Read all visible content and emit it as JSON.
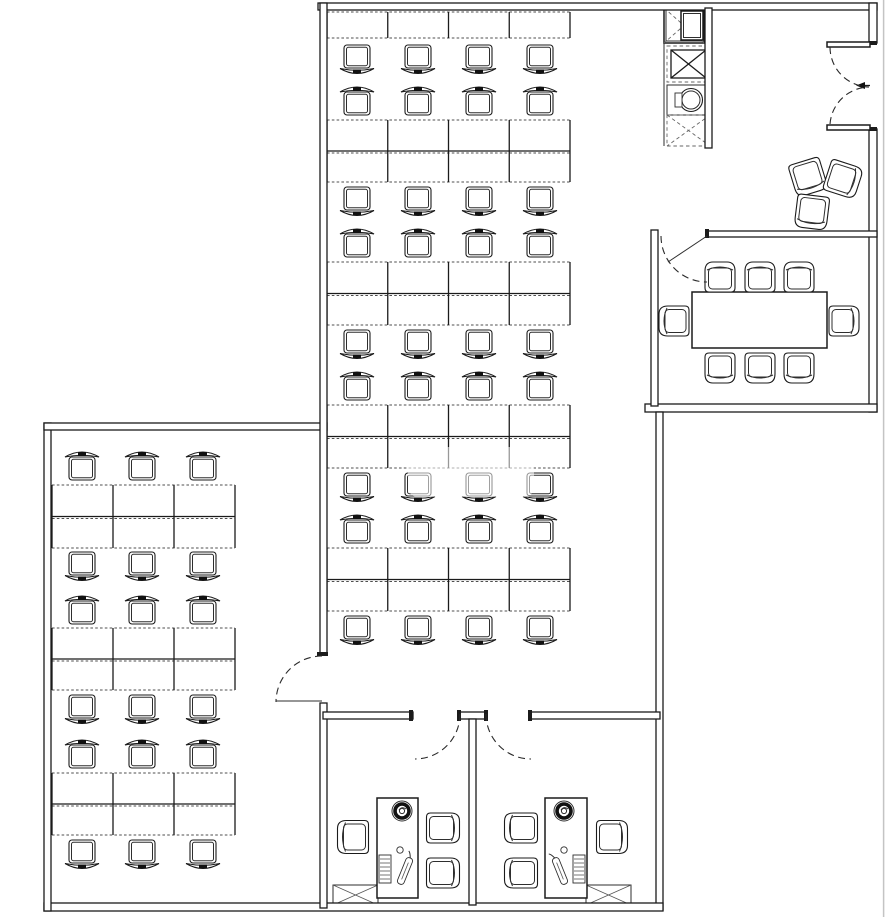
{
  "meta": {
    "title": "Office floor plan drawing",
    "canvas": {
      "w": 885,
      "h": 917
    },
    "colors": {
      "line": "#1b1b1b",
      "desk_dash": "#4f4f4f",
      "background": "#ffffff",
      "canvas_edge": "#c4c4c4"
    }
  },
  "plan": {
    "walls": [
      {
        "id": "top-wall",
        "x": 318,
        "y": 3,
        "w": 559,
        "h": 7
      },
      {
        "id": "right-wall-upper",
        "x": 869,
        "y": 3,
        "w": 8,
        "h": 40
      },
      {
        "id": "right-wall-mid",
        "x": 869,
        "y": 129,
        "w": 8,
        "h": 283
      },
      {
        "id": "conference-bottom-wall",
        "x": 645,
        "y": 404,
        "w": 232,
        "h": 8
      },
      {
        "id": "center-right-wall",
        "x": 656,
        "y": 412,
        "w": 7,
        "h": 498
      },
      {
        "id": "bottom-wall",
        "x": 44,
        "y": 903,
        "w": 619,
        "h": 8
      },
      {
        "id": "left-wing-left-wall",
        "x": 44,
        "y": 423,
        "w": 7,
        "h": 488
      },
      {
        "id": "left-wing-top-wall",
        "x": 44,
        "y": 423,
        "w": 283,
        "h": 7
      },
      {
        "id": "center-left-wall",
        "x": 320,
        "y": 3,
        "w": 7,
        "h": 652
      },
      {
        "id": "lower-left-wall",
        "x": 320,
        "y": 703,
        "w": 7,
        "h": 205
      },
      {
        "id": "office-top-wall-left",
        "x": 323,
        "y": 712,
        "w": 90,
        "h": 7
      },
      {
        "id": "office-top-wall-center",
        "x": 459,
        "y": 712,
        "w": 27,
        "h": 7
      },
      {
        "id": "office-top-wall-right",
        "x": 530,
        "y": 712,
        "w": 130,
        "h": 7
      },
      {
        "id": "office-divider-wall",
        "x": 469,
        "y": 719,
        "w": 7,
        "h": 186
      },
      {
        "id": "conference-left-wall",
        "x": 651,
        "y": 230,
        "w": 7,
        "h": 176
      },
      {
        "id": "conference-top-wall",
        "x": 707,
        "y": 231,
        "w": 170,
        "h": 6
      },
      {
        "id": "shaft-right-wall",
        "x": 705,
        "y": 8,
        "w": 7,
        "h": 140
      }
    ],
    "wall_caps": [
      {
        "x": 409,
        "y": 710,
        "w": 4,
        "h": 11
      },
      {
        "x": 457,
        "y": 710,
        "w": 4,
        "h": 11
      },
      {
        "x": 484,
        "y": 710,
        "w": 4,
        "h": 11
      },
      {
        "x": 528,
        "y": 710,
        "w": 4,
        "h": 11
      },
      {
        "x": 705,
        "y": 229,
        "w": 4,
        "h": 9
      },
      {
        "x": 317,
        "y": 652,
        "w": 11,
        "h": 4
      },
      {
        "x": 869,
        "y": 41,
        "w": 8,
        "h": 4
      },
      {
        "x": 869,
        "y": 127,
        "w": 8,
        "h": 4
      }
    ],
    "entry_door_leaves": [
      {
        "x": 827,
        "y": 42,
        "w": 43,
        "h": 5
      },
      {
        "x": 827,
        "y": 125,
        "w": 43,
        "h": 5
      }
    ],
    "entry_handle": {
      "x1": 856,
      "y1": 85.5,
      "x2": 870,
      "y2": 85.5
    },
    "door_swings": [
      {
        "id": "entry-door-top",
        "d": "M 830 47 A 40 40 0 0 0 869 87"
      },
      {
        "id": "entry-door-bottom",
        "d": "M 830 124 A 40 40 0 0 1 869 87"
      },
      {
        "id": "conference-door",
        "d": "M 661 236 A 46 46 0 0 0 707 282"
      },
      {
        "id": "left-wing-door",
        "d": "M 322 656 A 46 46 0 0 0 276 702"
      },
      {
        "id": "office-left-door",
        "d": "M 460 714 A 45 45 0 0 1 415 759"
      },
      {
        "id": "office-right-door",
        "d": "M 486 714 A 45 45 0 0 0 531 759"
      }
    ],
    "door_leaf_lines": [
      {
        "x1": 276,
        "y1": 701,
        "x2": 322,
        "y2": 701
      },
      {
        "x1": 707,
        "y1": 236,
        "x2": 668,
        "y2": 262
      }
    ],
    "desk_blocks": [
      {
        "id": "center-bank-1",
        "x": 327,
        "y": 12,
        "cols": 4,
        "colw": 60.75,
        "rows": 1,
        "rowh": 26
      },
      {
        "id": "center-bank-2",
        "x": 327,
        "y": 120,
        "cols": 4,
        "colw": 60.75,
        "rows": 2,
        "rowh": 31
      },
      {
        "id": "center-bank-3",
        "x": 327,
        "y": 262,
        "cols": 4,
        "colw": 60.75,
        "rows": 2,
        "rowh": 31.5
      },
      {
        "id": "center-bank-4",
        "x": 327,
        "y": 405,
        "cols": 4,
        "colw": 60.75,
        "rows": 2,
        "rowh": 31.5
      },
      {
        "id": "center-bank-5",
        "x": 327,
        "y": 548,
        "cols": 4,
        "colw": 60.75,
        "rows": 2,
        "rowh": 31.5
      },
      {
        "id": "left-bank-1",
        "x": 52,
        "y": 485,
        "cols": 3,
        "colw": 61,
        "rows": 2,
        "rowh": 31.5
      },
      {
        "id": "left-bank-2",
        "x": 52,
        "y": 628,
        "cols": 3,
        "colw": 61,
        "rows": 2,
        "rowh": 31
      },
      {
        "id": "left-bank-3",
        "x": 52,
        "y": 773,
        "cols": 3,
        "colw": 61,
        "rows": 2,
        "rowh": 31
      }
    ],
    "chair_rows": [
      {
        "area": "center",
        "dir": "up",
        "y": 45,
        "centers": [
          357,
          418,
          479,
          540
        ]
      },
      {
        "area": "center",
        "dir": "down",
        "y": 84,
        "centers": [
          357,
          418,
          479,
          540
        ]
      },
      {
        "area": "center",
        "dir": "up",
        "y": 187,
        "centers": [
          357,
          418,
          479,
          540
        ]
      },
      {
        "area": "center",
        "dir": "down",
        "y": 226,
        "centers": [
          357,
          418,
          479,
          540
        ]
      },
      {
        "area": "center",
        "dir": "up",
        "y": 330,
        "centers": [
          357,
          418,
          479,
          540
        ]
      },
      {
        "area": "center",
        "dir": "down",
        "y": 369,
        "centers": [
          357,
          418,
          479,
          540
        ]
      },
      {
        "area": "center",
        "dir": "up",
        "y": 473,
        "centers": [
          357,
          418,
          479,
          540
        ]
      },
      {
        "area": "center",
        "dir": "down",
        "y": 512,
        "centers": [
          357,
          418,
          479,
          540
        ]
      },
      {
        "area": "center",
        "dir": "up",
        "y": 616,
        "centers": [
          357,
          418,
          479,
          540
        ]
      },
      {
        "area": "left-wing",
        "dir": "down",
        "y": 449,
        "centers": [
          82,
          142,
          203
        ]
      },
      {
        "area": "left-wing",
        "dir": "up",
        "y": 552,
        "centers": [
          82,
          142,
          203
        ]
      },
      {
        "area": "left-wing",
        "dir": "down",
        "y": 593,
        "centers": [
          82,
          142,
          203
        ]
      },
      {
        "area": "left-wing",
        "dir": "up",
        "y": 695,
        "centers": [
          82,
          142,
          203
        ]
      },
      {
        "area": "left-wing",
        "dir": "down",
        "y": 737,
        "centers": [
          82,
          142,
          203
        ]
      },
      {
        "area": "left-wing",
        "dir": "up",
        "y": 840,
        "centers": [
          82,
          142,
          203
        ]
      }
    ],
    "conference_room": {
      "table": {
        "x": 692,
        "y": 292,
        "w": 135,
        "h": 56
      },
      "chair_size": {
        "w": 30,
        "h": 30
      },
      "chairs": [
        {
          "cx": 720,
          "cy": 277,
          "rot": 0
        },
        {
          "cx": 760,
          "cy": 277,
          "rot": 0
        },
        {
          "cx": 799,
          "cy": 277,
          "rot": 0
        },
        {
          "cx": 720,
          "cy": 368,
          "rot": 180
        },
        {
          "cx": 760,
          "cy": 368,
          "rot": 180
        },
        {
          "cx": 799,
          "cy": 368,
          "rot": 180
        },
        {
          "cx": 674,
          "cy": 321,
          "rot": -90
        },
        {
          "cx": 844,
          "cy": 321,
          "rot": 90
        }
      ]
    },
    "lounge_chairs": {
      "size": {
        "w": 32,
        "h": 33
      },
      "items": [
        {
          "cx": 808,
          "cy": 177,
          "rot": 163
        },
        {
          "cx": 843,
          "cy": 179,
          "rot": 108
        },
        {
          "cx": 812,
          "cy": 212,
          "rot": 187
        }
      ]
    },
    "shaft": {
      "left_edge": {
        "x": 664,
        "y1": 8,
        "y2": 146
      },
      "boxes": [
        {
          "id": "elevator-car",
          "x": 664,
          "y": 8,
          "w": 40,
          "h": 35,
          "style": "elevator"
        },
        {
          "id": "stair-shaft",
          "x": 667,
          "y": 46,
          "w": 43,
          "h": 36,
          "style": "solid-x"
        },
        {
          "id": "service-appliance",
          "x": 667,
          "y": 85,
          "w": 43,
          "h": 30,
          "style": "appliance"
        },
        {
          "id": "duct-shaft",
          "x": 667,
          "y": 115,
          "w": 43,
          "h": 31,
          "style": "dashed-x"
        }
      ]
    },
    "offices": [
      {
        "id": "left-office",
        "desk": {
          "x": 377,
          "y": 798,
          "w": 41,
          "h": 100
        },
        "fan": {
          "cx": 402,
          "cy": 811
        },
        "keyboard": {
          "x": 379,
          "y": 855,
          "w": 12,
          "h": 28
        },
        "mouse": {
          "cx": 400,
          "cy": 850
        },
        "phone": {
          "cx": 405,
          "cy": 871,
          "rot": 22
        },
        "exec_chair": {
          "cx": 353,
          "cy": 837,
          "rot": -90
        },
        "guest_chairs": [
          {
            "cx": 443,
            "cy": 828,
            "rot": 90
          },
          {
            "cx": 443,
            "cy": 873,
            "rot": 90
          }
        ],
        "cabinet": {
          "x": 333,
          "y": 885,
          "w": 45,
          "h": 20
        }
      },
      {
        "id": "right-office",
        "desk": {
          "x": 545,
          "y": 798,
          "w": 42,
          "h": 100
        },
        "fan": {
          "cx": 564,
          "cy": 811
        },
        "keyboard": {
          "x": 573,
          "y": 855,
          "w": 12,
          "h": 28
        },
        "mouse": {
          "cx": 564,
          "cy": 850
        },
        "phone": {
          "cx": 560,
          "cy": 871,
          "rot": -22
        },
        "exec_chair": {
          "cx": 612,
          "cy": 837,
          "rot": 90
        },
        "guest_chairs": [
          {
            "cx": 521,
            "cy": 828,
            "rot": -90
          },
          {
            "cx": 521,
            "cy": 873,
            "rot": -90
          }
        ],
        "cabinet": {
          "x": 586,
          "y": 885,
          "w": 45,
          "h": 20
        }
      }
    ],
    "watermark_patches": [
      {
        "x": 408,
        "y": 447,
        "w": 126,
        "h": 50
      },
      {
        "x": 374,
        "y": 648,
        "w": 88,
        "h": 46
      }
    ]
  }
}
